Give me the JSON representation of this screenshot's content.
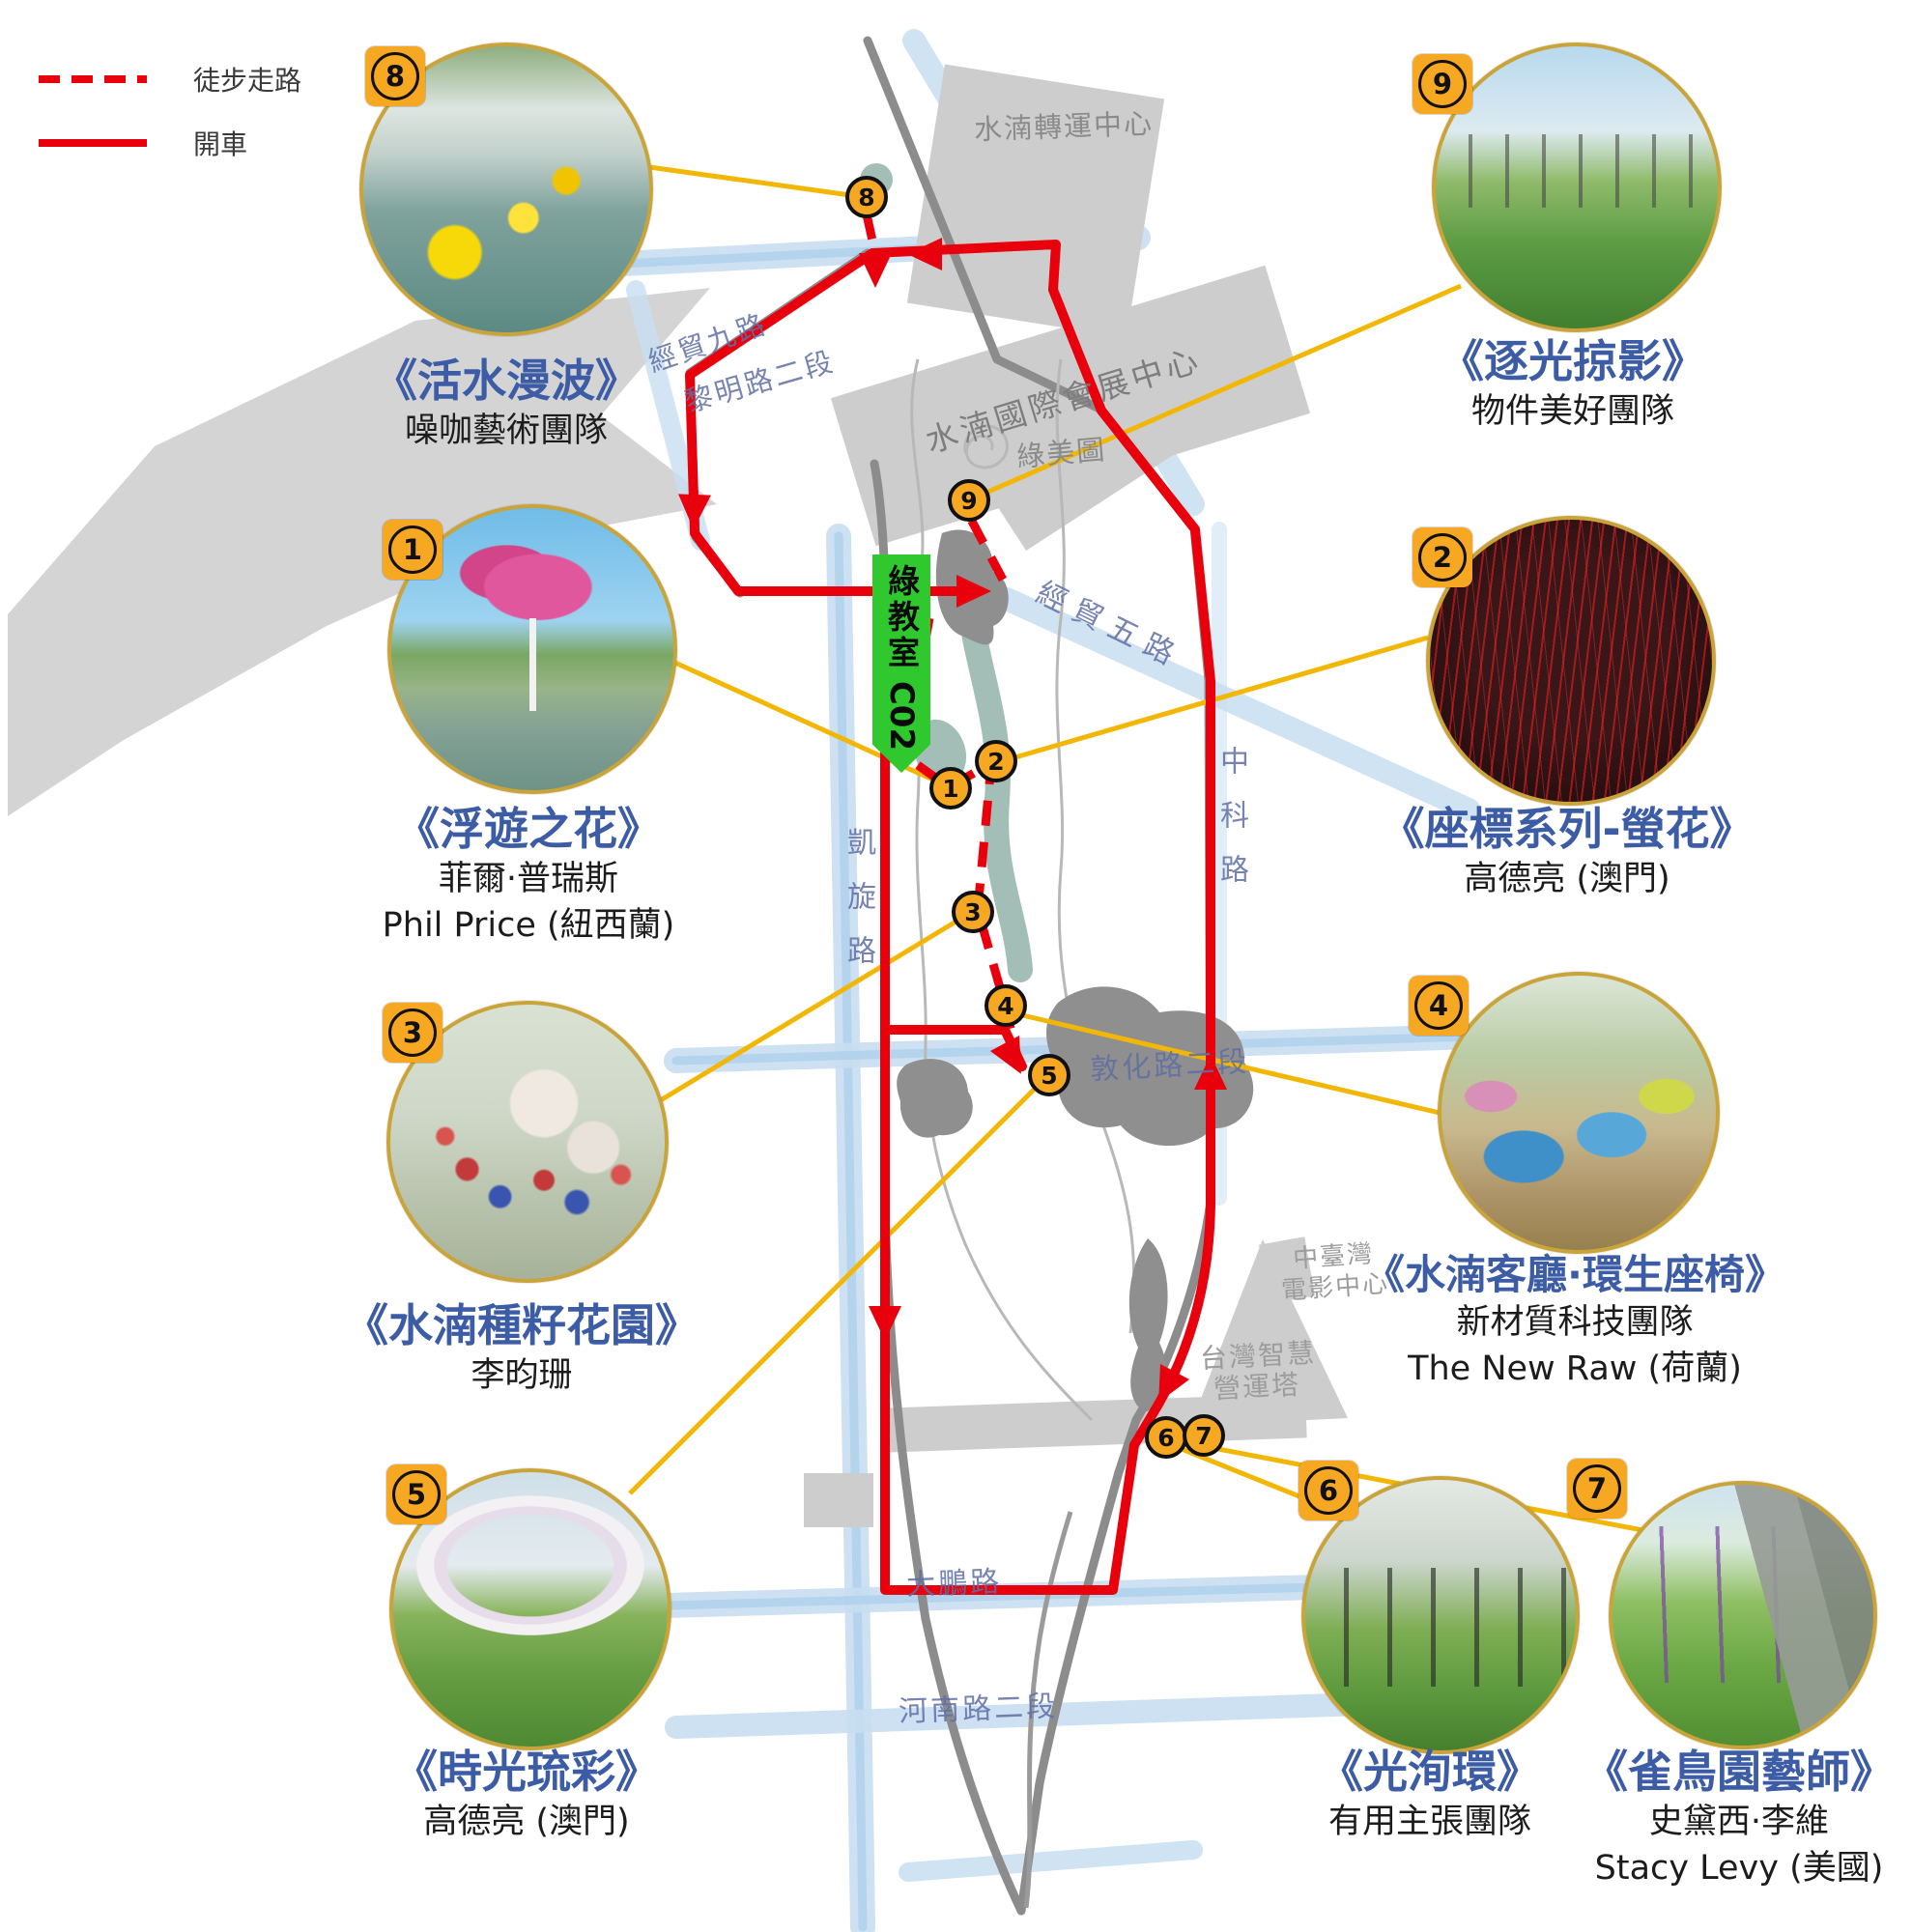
{
  "legend": {
    "walk": "徒步走路",
    "drive": "開車"
  },
  "artworks": [
    {
      "no": "1",
      "title": "《浮遊之花》",
      "artist": "菲爾·普瑞斯",
      "artist_en": "Phil Price (紐西蘭)"
    },
    {
      "no": "2",
      "title": "《座標系列-螢花》",
      "artist": "高德亮 (澳門)",
      "artist_en": ""
    },
    {
      "no": "3",
      "title": "《水湳種籽花園》",
      "artist": "李昀珊",
      "artist_en": ""
    },
    {
      "no": "4",
      "title": "《水湳客廳·環生座椅》",
      "artist": "新材質科技團隊",
      "artist_en": "The New Raw (荷蘭)"
    },
    {
      "no": "5",
      "title": "《時光琉彩》",
      "artist": "高德亮 (澳門)",
      "artist_en": ""
    },
    {
      "no": "6",
      "title": "《光洵環》",
      "artist": "有用主張團隊",
      "artist_en": ""
    },
    {
      "no": "7",
      "title": "《雀鳥園藝師》",
      "artist": "史黛西·李維",
      "artist_en": "Stacy Levy (美國)"
    },
    {
      "no": "8",
      "title": "《活水漫波》",
      "artist": "噪咖藝術團隊",
      "artist_en": ""
    },
    {
      "no": "9",
      "title": "《逐光掠影》",
      "artist": "物件美好團隊",
      "artist_en": ""
    }
  ],
  "markers": [
    "1",
    "2",
    "3",
    "4",
    "5",
    "6",
    "7",
    "8",
    "9"
  ],
  "map_labels": {
    "transit_center": "水湳轉運中心",
    "jingmao9": "經貿九路",
    "liming2": "黎明路二段",
    "convention_center": "水湳國際會展中心",
    "green_museum": "綠美圖",
    "jingmao5": "經貿五路",
    "kaixuan": "凱旋路",
    "zhongke": "中科路",
    "dunhua2": "敦化路二段",
    "movie_center_l1": "中臺灣",
    "movie_center_l2": "電影中心",
    "smart_tower_l1": "台灣智慧",
    "smart_tower_l2": "營運塔",
    "dapeng": "大鵬路",
    "henan2": "河南路二段"
  },
  "green_banner": {
    "text": "綠教室",
    "code": "C02"
  },
  "colors": {
    "route_red": "#e8000d",
    "connector_yellow": "#f2b705",
    "marker_orange": "#f7a823",
    "title_blue": "#3c5ca6",
    "banner_green": "#2fc92f",
    "road_blue": "#c8def1"
  }
}
